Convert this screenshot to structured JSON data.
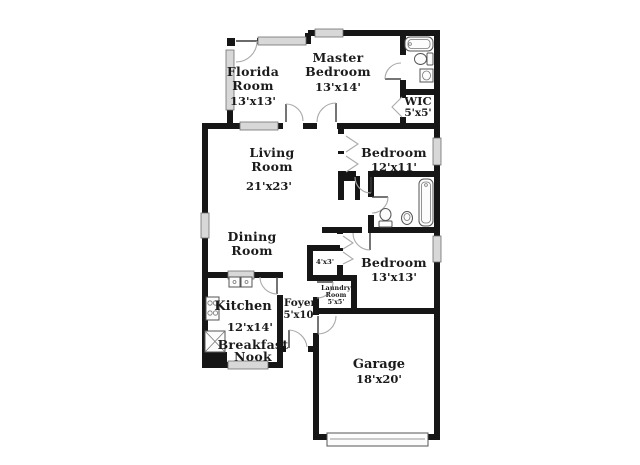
{
  "colors": {
    "wall": "#161616",
    "window_fill": "#d8d8d8",
    "door_arc": "#a9a9a9",
    "fixture_stroke": "#555555",
    "background": "#ffffff",
    "text": "#1b1b1b"
  },
  "labels": {
    "florida_1": "Florida",
    "florida_2": "Room",
    "florida_3": "13'x13'",
    "master_1": "Master",
    "master_2": "Bedroom",
    "master_3": "13'x14'",
    "wic_1": "WIC",
    "wic_2": "5'x5'",
    "living_1": "Living",
    "living_2": "Room",
    "living_3": "21'x23'",
    "bed12_1": "Bedroom",
    "bed12_2": "12'x11'",
    "dining_1": "Dining",
    "dining_2": "Room",
    "closet43": "4'x3'",
    "bed13_1": "Bedroom",
    "bed13_2": "13'x13'",
    "laundry_1": "Laundry",
    "laundry_2": "Room",
    "laundry_3": "5'x5'",
    "kitchen_1": "Kitchen",
    "kitchen_2": "12'x14'",
    "nook_1": "Breakfast",
    "nook_2": "Nook",
    "foyer_1": "Foyer",
    "foyer_2": "5'x10'",
    "garage_1": "Garage",
    "garage_2": "18'x20'"
  }
}
